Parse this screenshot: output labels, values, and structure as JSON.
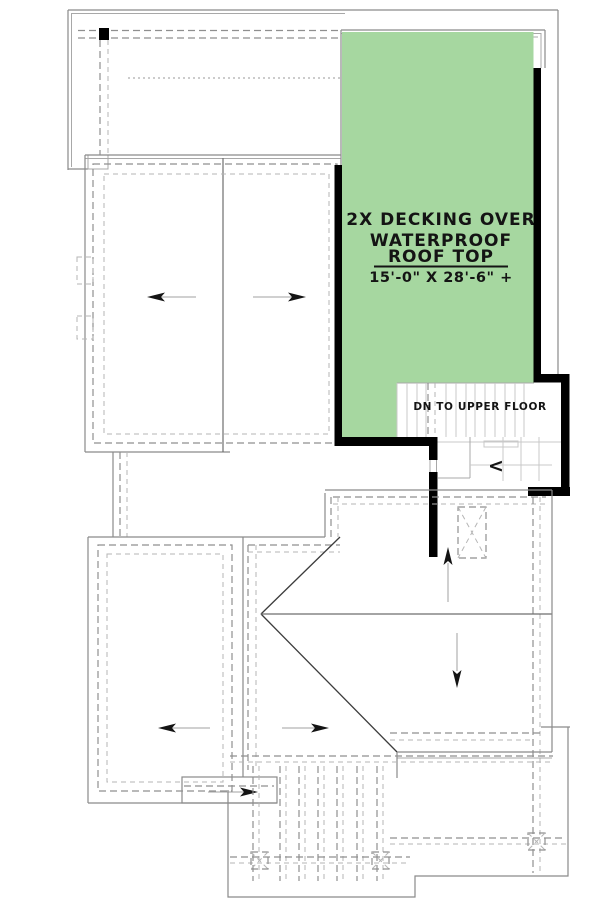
{
  "plan": {
    "deck_label": {
      "line1": "2X DECKING OVER",
      "line2": "WATERPROOF",
      "line3": "ROOF TOP",
      "dimension": "15'-0\" X 28'-6\" +"
    },
    "stairs": {
      "label": "DN TO UPPER FLOOR",
      "chevron": "<"
    },
    "colors": {
      "deck_fill": "#a6d7a0",
      "wall": "#000000",
      "roof_outline": "#8a8a8a",
      "dashed_line": "#9a9a9a",
      "tread_line": "#c9c9c9",
      "text": "#141414"
    }
  }
}
